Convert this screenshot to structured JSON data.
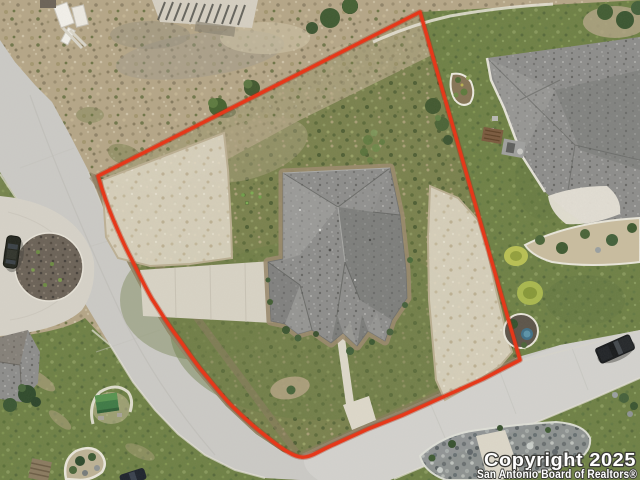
{
  "watermark": {
    "line1": "Copyright 2025",
    "line2": "San Antonio Board of Realtors®"
  },
  "colors": {
    "boundary_red": "#e6381a",
    "watermark_fill": "#ffffff",
    "roof_gray": "#8d8d8b",
    "road_gray": "#cbcac6",
    "concrete": "#d8d3c5",
    "lawn_green": "#6e8045",
    "scrub_green": "#79814d",
    "dirt_tan": "#b5a687",
    "rock_gray": "#8e9394"
  },
  "scene": {
    "alt": "Aerial drone photo of a corner home lot outlined in red on a curved residential street with cul-de-sac, gray shingle roof house, caliche pads, and neighboring yards"
  }
}
